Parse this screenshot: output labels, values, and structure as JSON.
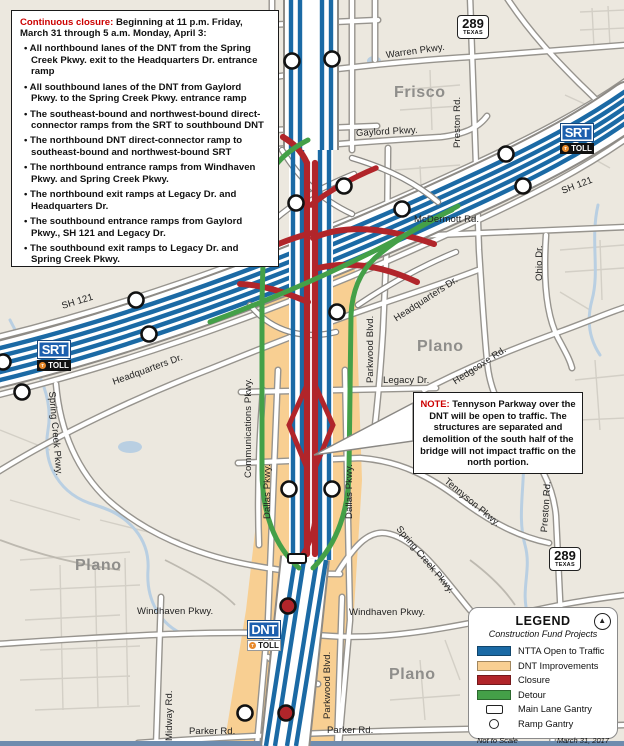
{
  "closure_box": {
    "title_red": "Continuous closure:",
    "title_rest": " Beginning at 11 p.m. Friday, March 31 through 5 a.m. Monday, April 3:",
    "bullets": [
      "All northbound lanes of the DNT from the Spring Creek Pkwy. exit to the Headquarters Dr. entrance ramp",
      "All southbound lanes of the DNT from Gaylord Pkwy. to the Spring Creek Pkwy. entrance ramp",
      "The southeast-bound and northwest-bound direct-connector ramps from the SRT to southbound DNT",
      "The northbound DNT direct-connector ramp to southeast-bound and northwest-bound SRT",
      "The northbound entrance ramps from Windhaven Pkwy. and Spring Creek Pkwy.",
      "The northbound exit ramps at Legacy Dr. and Headquarters Dr.",
      "The southbound entrance ramps from Gaylord Pkwy., SH 121 and Legacy Dr.",
      "The southbound exit ramps to Legacy Dr. and Spring Creek Pkwy."
    ]
  },
  "note_box": {
    "label": "NOTE:",
    "text": " Tennyson Parkway over the DNT will be open to traffic. The structures are separated and demolition of the south half of the bridge will not impact traffic on the north portion."
  },
  "legend": {
    "title": "LEGEND",
    "subtitle": "Construction Fund Projects",
    "items": [
      {
        "label": "NTTA Open to Traffic",
        "color": "#1b6aa5"
      },
      {
        "label": "DNT Improvements",
        "color": "#f8cf92"
      },
      {
        "label": "Closure",
        "color": "#b1252a"
      },
      {
        "label": "Detour",
        "color": "#44a048"
      },
      {
        "label": "Main Lane Gantry",
        "symbol": "rect-outline"
      },
      {
        "label": "Ramp Gantry",
        "symbol": "circle-outline"
      }
    ],
    "footer_left": "Not to Scale",
    "footer_right": "March 31, 2017"
  },
  "shields": {
    "route": "289",
    "state": "TEXAS"
  },
  "logos": {
    "srt": "SRT",
    "dnt": "DNT",
    "toll": "TOLL",
    "toll_dot": "T"
  },
  "icons": {
    "north_arrow": "▲"
  },
  "labels": {
    "warren": "Warren Pkwy.",
    "gaylord": "Gaylord Pkwy.",
    "preston": "Preston Rd.",
    "mcdermott": "McDermott Rd.",
    "ohio": "Ohio Dr.",
    "sh121": "SH 121",
    "headquarters": "Headquarters Dr.",
    "parkwood": "Parkwood Blvd.",
    "legacy": "Legacy Dr.",
    "hedgcoxe": "Hedgcoxe Rd.",
    "communications": "Communications Pkwy.",
    "dallas": "Dallas Pkwy.",
    "spring_creek": "Spring Creek Pkwy.",
    "tennyson": "Tennyson Pkwy.",
    "windhaven": "Windhaven Pkwy.",
    "midway": "Midway Rd.",
    "parker": "Parker Rd."
  },
  "cities": {
    "frisco": "Frisco",
    "plano": "Plano"
  },
  "colors": {
    "ntta_blue": "#1b6aa5",
    "dnt_improvements_orange": "#f8cf92",
    "closure_red": "#b1252a",
    "detour_green": "#44a048",
    "map_background": "#ece8df",
    "road_casing": "#97948e",
    "note_red": "#cc0000",
    "water_blue": "#b9cfe2",
    "neatline_blue": "#6e8cae"
  }
}
